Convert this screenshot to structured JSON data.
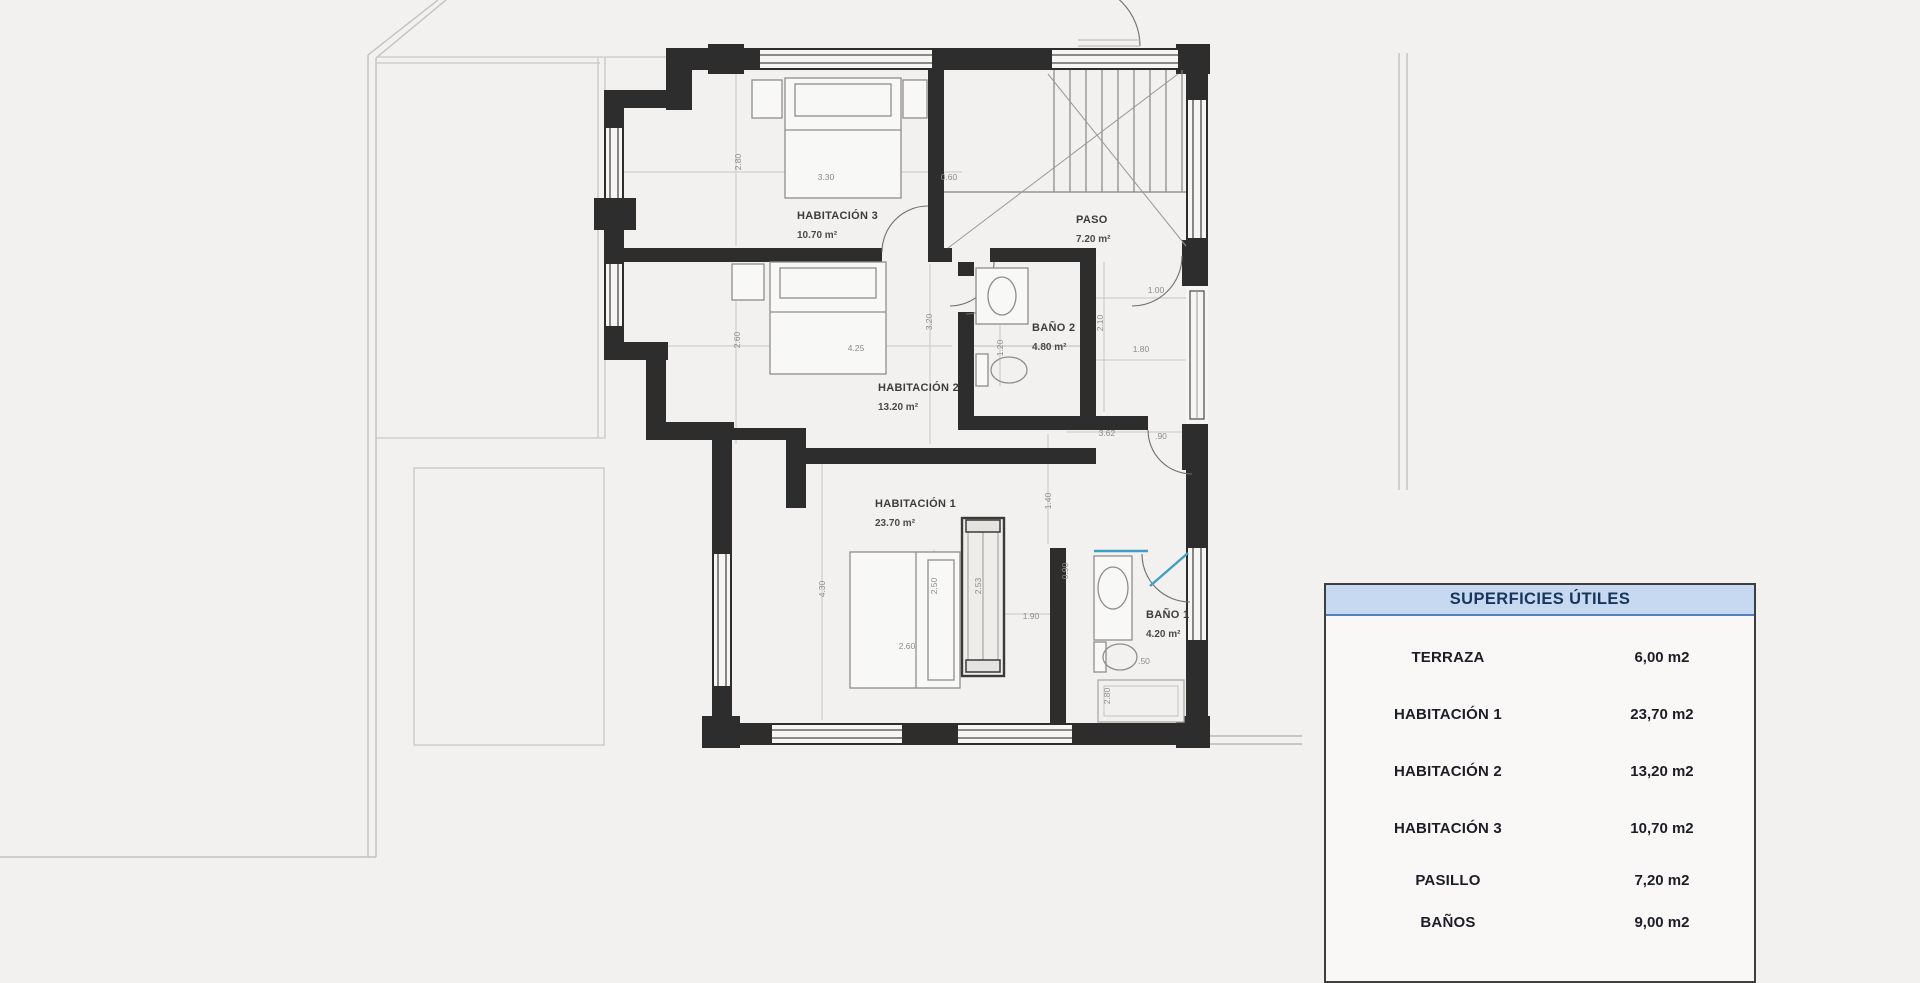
{
  "plan": {
    "rooms": [
      {
        "name": "HABITACIÓN 3",
        "area": "10.70 m²"
      },
      {
        "name": "PASO",
        "area": "7.20 m²"
      },
      {
        "name": "HABITACIÓN 2",
        "area": "13.20 m²"
      },
      {
        "name": "BAÑO 2",
        "area": "4.80 m²"
      },
      {
        "name": "HABITACIÓN 1",
        "area": "23.70 m²"
      },
      {
        "name": "BAÑO 1",
        "area": "4.20 m²"
      }
    ],
    "dims": [
      "2.80",
      "3.30",
      "0.60",
      "2.60",
      "4.25",
      "3.20",
      "1.20",
      "1.00",
      "2.10",
      "1.80",
      "3.62",
      ".90",
      "1.40",
      "4.30",
      "2.50",
      "2.53",
      "0.90",
      "1.90",
      "2.60",
      ".50",
      "2.80"
    ]
  },
  "table": {
    "header": "SUPERFICIES ÚTILES",
    "rows": [
      {
        "label": "TERRAZA",
        "value": "6,00 m2"
      },
      {
        "label": "HABITACIÓN 1",
        "value": "23,70 m2"
      },
      {
        "label": "HABITACIÓN 2",
        "value": "13,20 m2"
      },
      {
        "label": "HABITACIÓN 3",
        "value": "10,70 m2"
      },
      {
        "label": "PASILLO",
        "value": "7,20 m2"
      },
      {
        "label": "BAÑOS",
        "value": "9,00 m2"
      }
    ]
  },
  "colors": {
    "wall": "#2d2d2d",
    "glass": "#3f9ec4",
    "table_header_bg": "#c6d9f0",
    "table_header_text": "#17365d",
    "table_header_border": "#4f81bd"
  }
}
